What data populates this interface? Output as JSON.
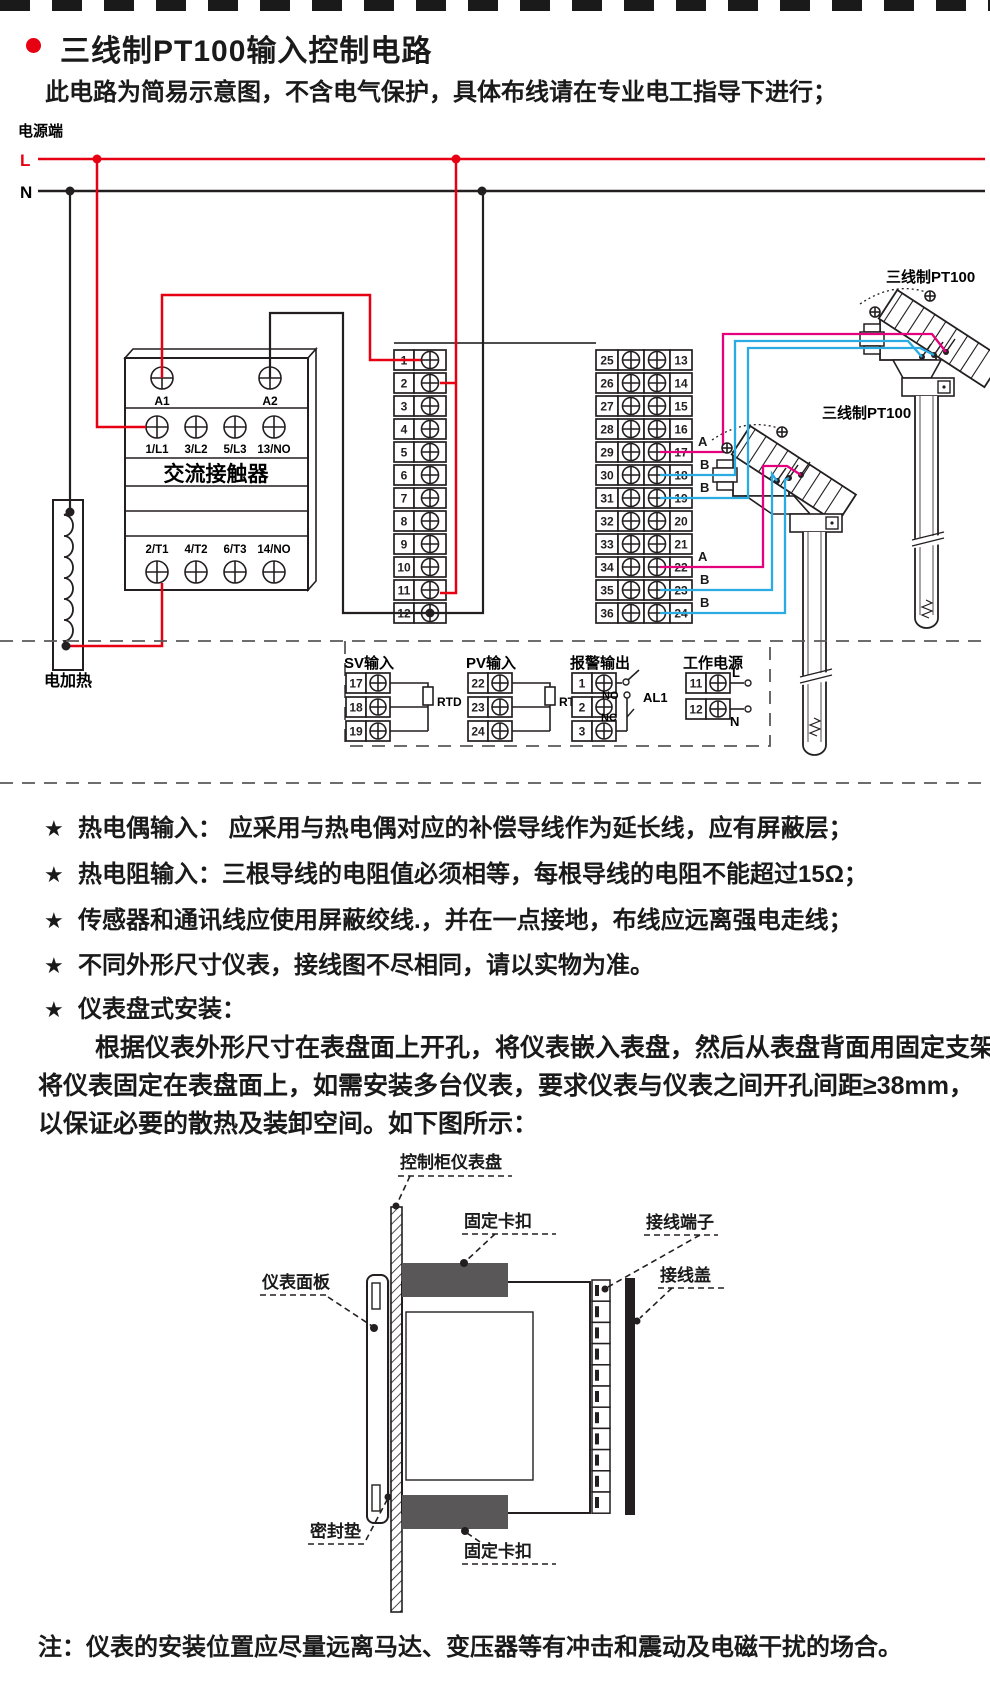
{
  "page": {
    "title": "三线制PT100输入控制电路",
    "subtitle": "此电路为简易示意图，不含电气保护，具体布线请在专业电工指导下进行；",
    "note": "注：仪表的安装位置应尽量远离马达、变压器等有冲击和震动及电磁干扰的场合。"
  },
  "schematic": {
    "power_label": "电源端",
    "line_l": "L",
    "line_n": "N",
    "heater_label": "电加热",
    "sensor_label": "三线制PT100",
    "contactor": {
      "name": "交流接触器",
      "coil_terminals": [
        "A1",
        "A2"
      ],
      "input_terminals": [
        "1/L1",
        "3/L2",
        "5/L3",
        "13/NO"
      ],
      "output_terminals": [
        "2/T1",
        "4/T2",
        "6/T3",
        "14/NO"
      ]
    },
    "left_strip": [
      "1",
      "2",
      "3",
      "4",
      "5",
      "6",
      "7",
      "8",
      "9",
      "10",
      "11",
      "12"
    ],
    "right_strip_outer": [
      "25",
      "26",
      "27",
      "28",
      "29",
      "30",
      "31",
      "32",
      "33",
      "34",
      "35",
      "36"
    ],
    "right_strip_inner": [
      "13",
      "14",
      "15",
      "16",
      "17",
      "18",
      "19",
      "20",
      "21",
      "22",
      "23",
      "24"
    ],
    "wire_tags": [
      "A",
      "B",
      "B",
      "A",
      "B",
      "B"
    ],
    "sections": {
      "sv": {
        "title": "SV输入",
        "terminals": [
          "17",
          "18",
          "19"
        ],
        "component": "RTD"
      },
      "pv": {
        "title": "PV输入",
        "terminals": [
          "22",
          "23",
          "24"
        ],
        "component": "RTD"
      },
      "alarm": {
        "title": "报警输出",
        "terminals": [
          "1",
          "2",
          "3"
        ],
        "no": "NO",
        "nc": "NC",
        "relay": "AL1"
      },
      "supply": {
        "title": "工作电源",
        "terminals": [
          "11",
          "12"
        ],
        "l": "L",
        "n": "N"
      }
    },
    "colors": {
      "live": "#e60012",
      "neutral": "#231f20",
      "wire_a": "#e5017d",
      "wire_b": "#2aabe2"
    }
  },
  "notes": {
    "star": "★",
    "bullets": [
      "热电偶输入： 应采用与热电偶对应的补偿导线作为延长线，应有屏蔽层；",
      "热电阻输入：三根导线的电阻值必须相等，每根导线的电阻不能超过15Ω；",
      "传感器和通讯线应使用屏蔽绞线.，并在一点接地，布线应远离强电走线；",
      "不同外形尺寸仪表，接线图不尽相同，请以实物为准。",
      "仪表盘式安装："
    ]
  },
  "install": {
    "paragraph": [
      "根据仪表外形尺寸在表盘面上开孔，将仪表嵌入表盘，然后从表盘背面用固定支架",
      "将仪表固定在表盘面上，如需安装多台仪表，要求仪表与仪表之间开孔间距≥38mm，",
      "以保证必要的散热及装卸空间。如下图所示："
    ],
    "labels": {
      "panel": "控制柜仪表盘",
      "clip": "固定卡扣",
      "terminal": "接线端子",
      "cover": "接线盖",
      "faceplate": "仪表面板",
      "gasket": "密封垫"
    }
  }
}
